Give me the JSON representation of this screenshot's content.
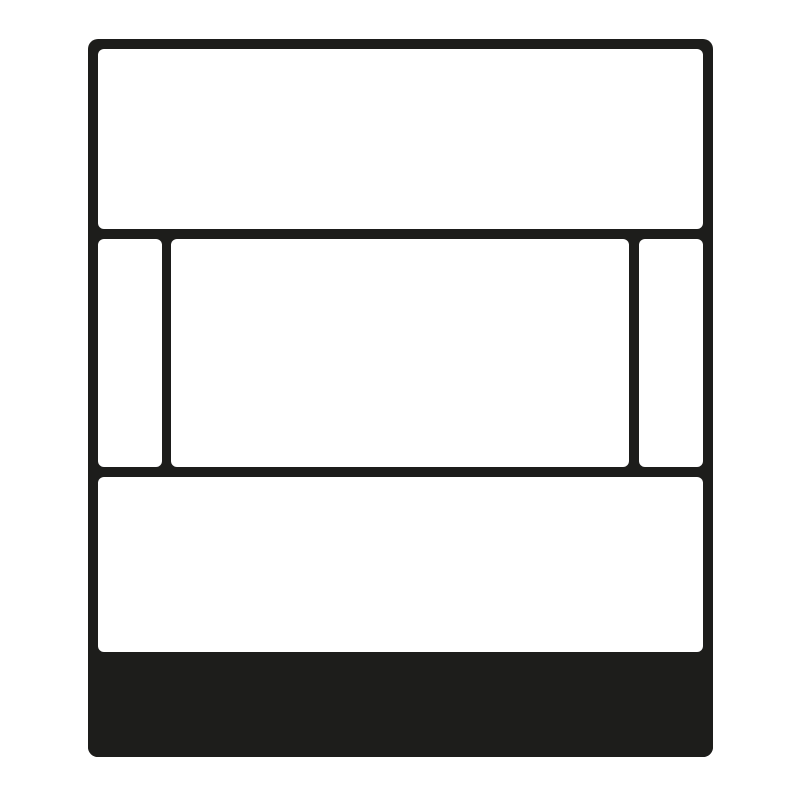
{
  "figure": {
    "type": "pictogram",
    "colors": {
      "line": "#1d1d1b",
      "fill": "#ffffff",
      "background": "#ffffff"
    },
    "regions": [
      {
        "name": "faceplate-outline",
        "shape": "rounded-rectangle",
        "fill": "#1d1d1b"
      },
      {
        "name": "top-panel",
        "shape": "rounded-rectangle",
        "fill": "#ffffff"
      },
      {
        "name": "middle-left-panel",
        "shape": "rounded-rectangle",
        "fill": "#ffffff"
      },
      {
        "name": "middle-center-panel",
        "shape": "rounded-rectangle",
        "fill": "#ffffff"
      },
      {
        "name": "middle-right-panel",
        "shape": "rounded-rectangle",
        "fill": "#ffffff"
      },
      {
        "name": "bottom-panel",
        "shape": "rounded-rectangle",
        "fill": "#ffffff"
      },
      {
        "name": "base-band",
        "shape": "rectangle",
        "fill": "#1d1d1b"
      }
    ],
    "text": []
  }
}
